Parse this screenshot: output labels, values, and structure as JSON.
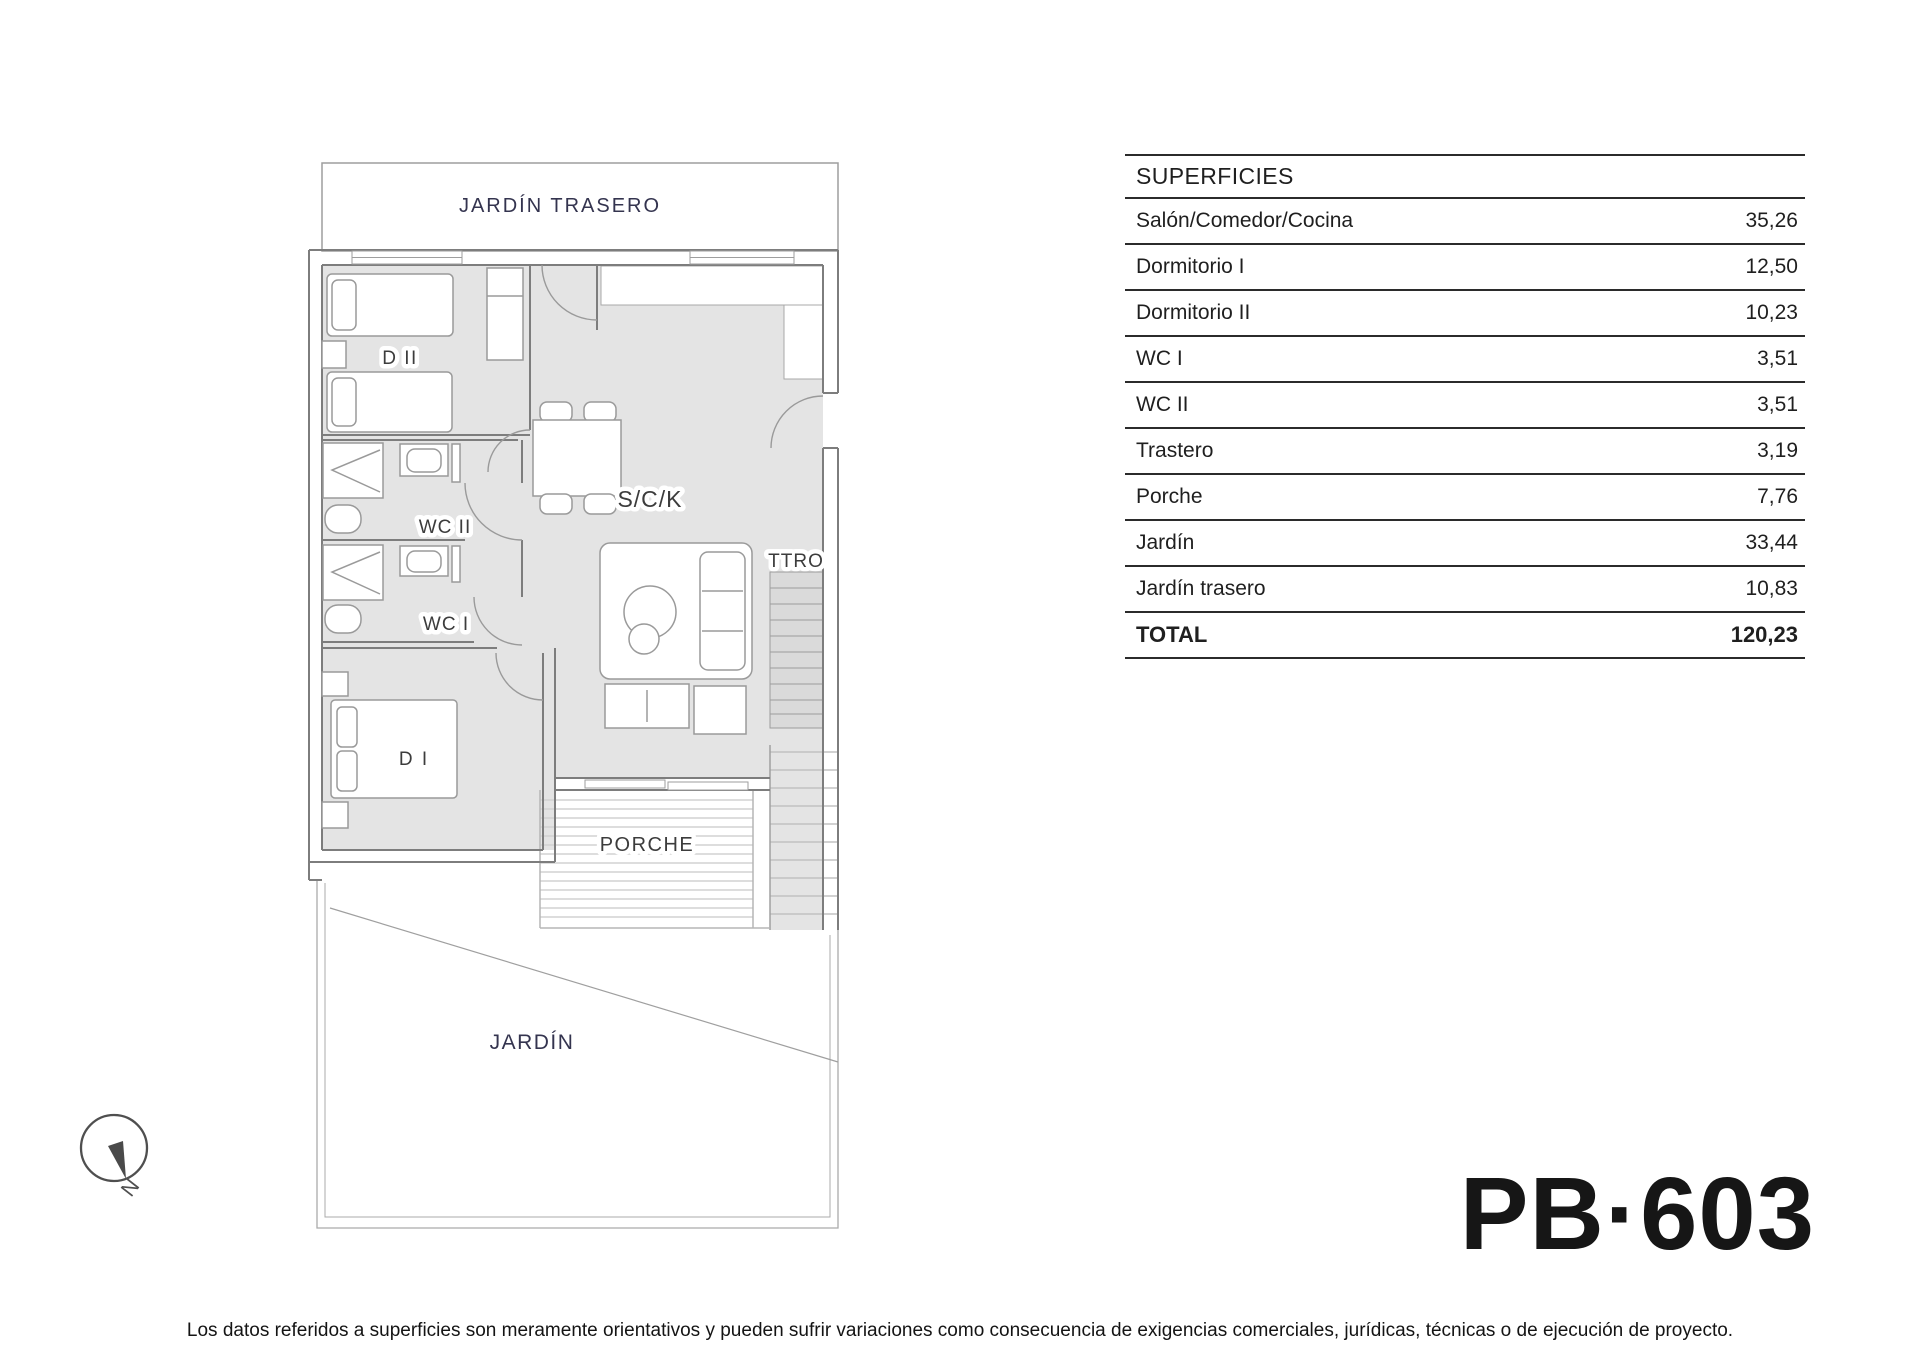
{
  "plan": {
    "labels": {
      "jardin_trasero": "JARDÍN TRASERO",
      "dormitorio2": "D II",
      "wc2": "WC II",
      "wc1": "WC I",
      "dormitorio1": "D I",
      "salon": "S/C/K",
      "trastero": "TTRO",
      "porche": "PORCHE",
      "jardin": "JARDÍN",
      "north": "N"
    }
  },
  "table": {
    "header": "SUPERFICIES",
    "rows": [
      {
        "label": "Salón/Comedor/Cocina",
        "value": "35,26"
      },
      {
        "label": "Dormitorio I",
        "value": "12,50"
      },
      {
        "label": "Dormitorio II",
        "value": "10,23"
      },
      {
        "label": "WC I",
        "value": "3,51"
      },
      {
        "label": "WC II",
        "value": "3,51"
      },
      {
        "label": "Trastero",
        "value": "3,19"
      },
      {
        "label": "Porche",
        "value": "7,76"
      },
      {
        "label": "Jardín",
        "value": "33,44"
      },
      {
        "label": "Jardín trasero",
        "value": "10,83"
      }
    ],
    "total": {
      "label": "TOTAL",
      "value": "120,23"
    }
  },
  "plan_code": "PB·603",
  "disclaimer": "Los datos referidos a superficies son meramente orientativos y pueden sufrir variaciones como consecuencia de exigencias comerciales, jurídicas, técnicas o de ejecución de proyecto.",
  "colors": {
    "floor_gray": "#e4e4e4",
    "wall_gray": "#7d7d7d",
    "label_navy": "#34344f",
    "table_line": "#2b2b2b"
  }
}
